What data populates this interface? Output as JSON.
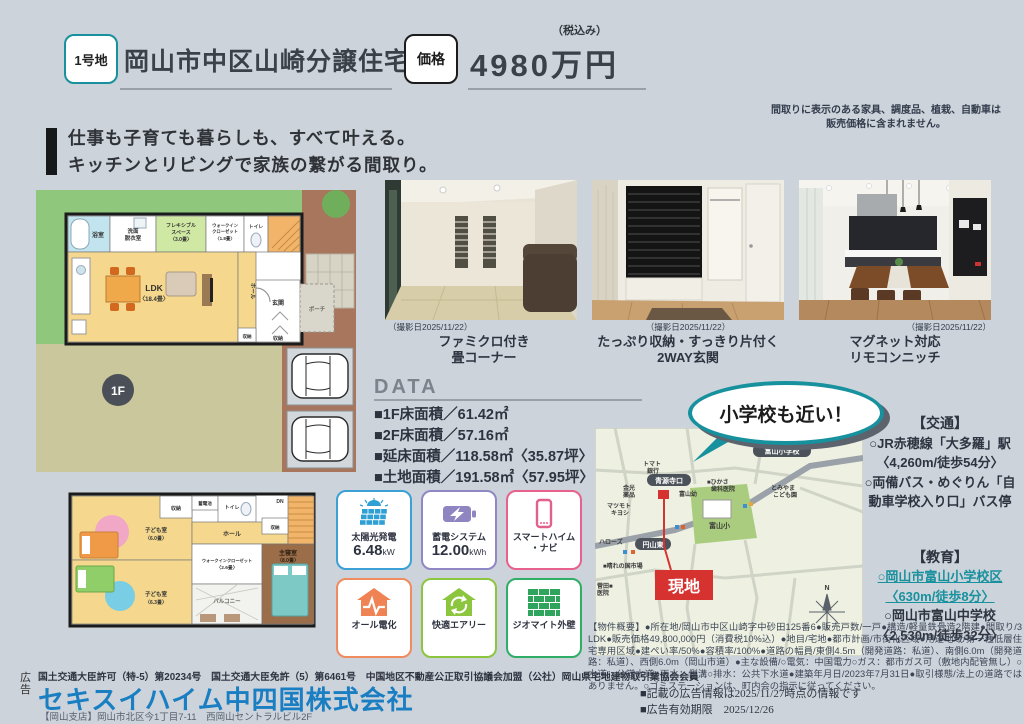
{
  "colors": {
    "accent_teal": "#18919e",
    "company_blue": "#1a7ec2",
    "site_red": "#d63330",
    "navy": "#2e3340",
    "background": "#cdd3da"
  },
  "header": {
    "lot_badge": "1号地",
    "title": "岡山市中区山崎分譲住宅",
    "price_label": "価格",
    "tax_note": "（税込み）",
    "price": "4980万円"
  },
  "disclaimer": {
    "line1": "間取りに表示のある家具、調度品、植栽、自動車は",
    "line2": "販売価格に含まれません。"
  },
  "tagline": {
    "line1": "仕事も子育ても暮らしも、すべて叶える。",
    "line2": "キッチンとリビングで家族の繋がる間取り。"
  },
  "fp1": {
    "badge": "1F",
    "bath": "浴室",
    "wash1": "洗面",
    "wash2": "脱衣室",
    "flex1": "フレキシブル",
    "flex2": "スペース",
    "flex3": "〈3.0畳〉",
    "wic1": "ウォークイン",
    "wic2": "クローゼット",
    "wic3": "〈1.8畳〉",
    "toilet": "トイレ",
    "ldk1": "LDK",
    "ldk2": "〈18.4畳〉",
    "hall": "ホール",
    "storage_a": "収納",
    "entrance": "玄関",
    "storage_b": "収納",
    "porch": "ポーチ"
  },
  "fp2": {
    "kids1a": "子ども室",
    "kids1b": "〈6.0畳〉",
    "kids2a": "子ども室",
    "kids2b": "〈6.3畳〉",
    "storage_a": "収納",
    "battery": "蓄電池",
    "toilet": "トイレ",
    "hall": "ホール",
    "wic1": "ウォークインクローゼット",
    "wic2": "〈2.6畳〉",
    "balcony": "バルコニー",
    "master1": "主寝室",
    "master2": "〈8.0畳〉",
    "storage_b": "収納",
    "dn": "DN"
  },
  "photos": [
    {
      "date": "（撮影日2025/11/22）",
      "cap1": "ファミクロ付き",
      "cap2": "畳コーナー"
    },
    {
      "date": "（撮影日2025/11/22）",
      "cap1": "たっぷり収納・すっきり片付く",
      "cap2": "2WAY玄関"
    },
    {
      "date": "（撮影日2025/11/22）",
      "cap1": "マグネット対応",
      "cap2": "リモコンニッチ"
    }
  ],
  "data_section": {
    "title": "DATA",
    "items": [
      "■1F床面積／61.42㎡",
      "■2F床面積／57.16㎡",
      "■延床面積／118.58㎡〈35.87坪〉",
      "■土地面積／191.58㎡〈57.95坪〉"
    ]
  },
  "features": {
    "solar_label": "太陽光発電",
    "solar_value": "6.48",
    "solar_unit": "kW",
    "battery_label": "蓄電システム",
    "battery_value": "12.00",
    "battery_unit": "kWh",
    "navi_label1": "スマートハイム",
    "navi_label2": "・ナビ",
    "electric_label": "オール電化",
    "airy_label": "快適エアリー",
    "wall_label": "ジオマイト外壁"
  },
  "map": {
    "bubble": "小学校も近い！",
    "site": "現地",
    "labels": {
      "school_pill": "富山小学校",
      "busstop1": "青源寺口",
      "bank1": "トマト",
      "bank2": "銀行",
      "pharm1": "金光",
      "pharm2": "薬品",
      "matsu1": "マツモト",
      "matsu2": "キヨシ",
      "kinder": "富山幼",
      "dental1": "■ひかさ",
      "dental2": "歯科医院",
      "kodomo1": "とみやま",
      "kodomo2": "こども園",
      "school_area": "富山小",
      "hellows": "ハローズ",
      "busstop2": "円山東",
      "market": "■晴れの国市場",
      "clinic1": "菅田■",
      "clinic2": "医院",
      "compass": "N"
    }
  },
  "access": {
    "transport_title": "【交通】",
    "t1": "○JR赤穂線「大多羅」駅",
    "t2": "〈4,260m/徒歩54分〉",
    "t3": "○両備バス・めぐりん「自",
    "t4": "動車学校入り口」バス停",
    "education_title": "【教育】",
    "e1": "○岡山市富山小学校区",
    "e2": "〈630m/徒歩8分〉",
    "e3": "○岡山市富山中学校",
    "e4": "〈2,530m/徒歩32分〉"
  },
  "outline": {
    "text": "【物件概要】●所在地/岡山市中区山崎字中砂田125番6●販売戸数/一戸●構造/軽量鉄骨造2階建●間取り/3 LDK●販売価格49,800,000円（消費税10%込）●地目/宅地●都市計画/市街化区域●用途地域/第一種低層住宅専用区域●建ぺい率/50%●容積率/100%●道路の幅員/東側4.5m（開発道路：私道）、南側6.0m（開発道路：私道）、西側6.0m（岡山市道）●主な設備/○電気：中国電力○ガス：都市ガス可（敷地内配管無し）○水道：公営水道○雨水：側溝○排水：公共下水道●建築年月日/2023年7月31日●取引様態/法上の道路ではありません。○ゴミステーションは、町内会の指示に従ってください。"
  },
  "footer": {
    "ad_vert1": "広",
    "ad_vert2": "告",
    "license": "国土交通大臣許可（特-5）第20234号　国土交通大臣免許（5）第6461号　中国地区不動産公正取引協議会加盟（公社）岡山県宅地建物取引業協会会員",
    "company": "セキスイハイム中四国株式会社",
    "branch": "【岡山支店】岡山市北区今1丁目7-11　西岡山セントラルビル2F",
    "info1": "■記載の広告情報は2025/11/27時点の情報です",
    "info2": "■広告有効期限　2025/12/26"
  }
}
